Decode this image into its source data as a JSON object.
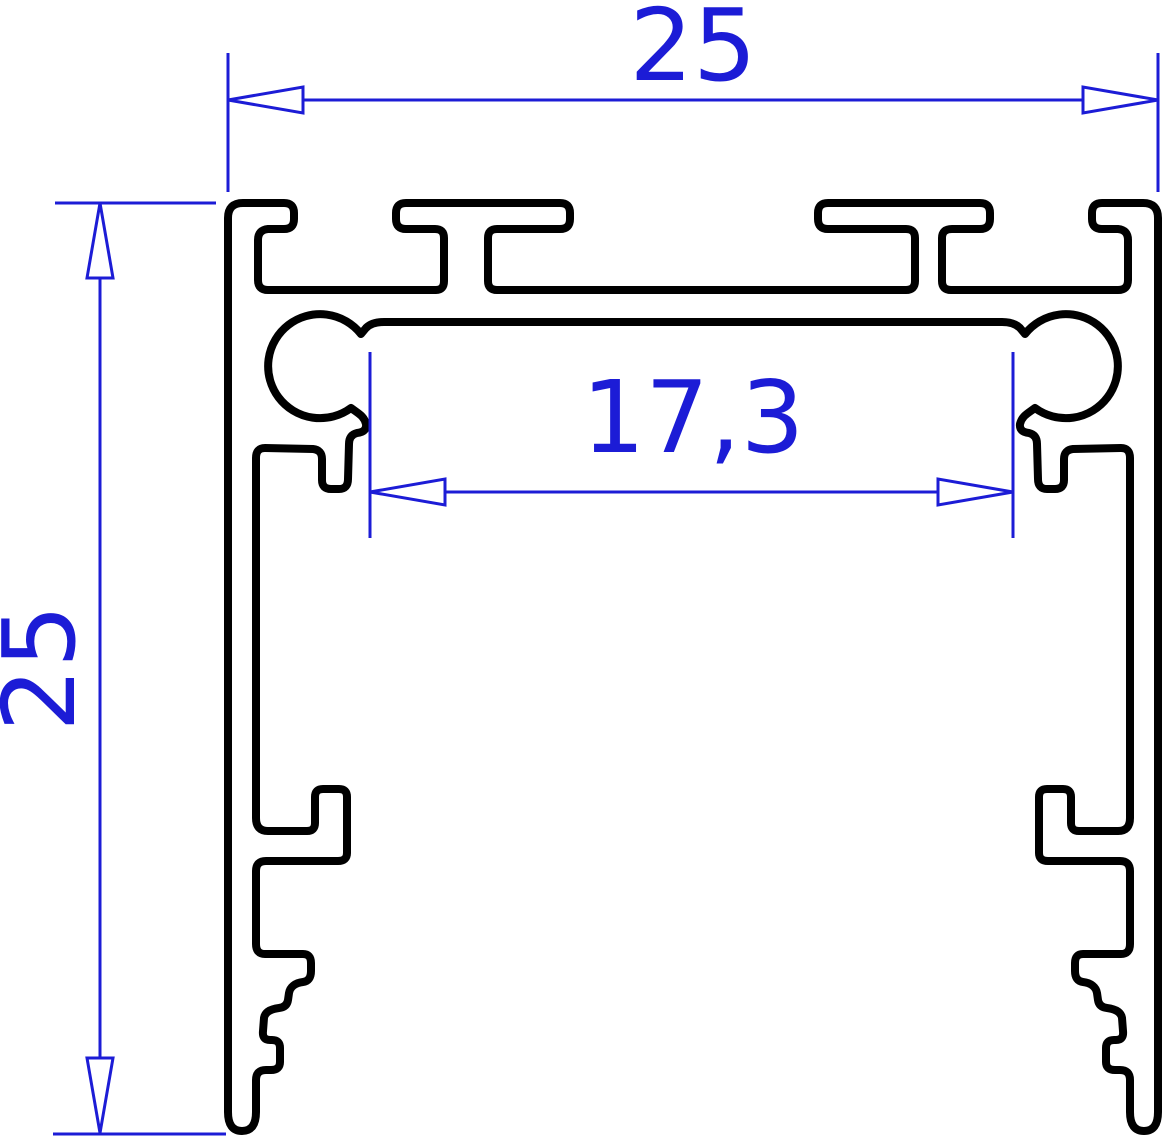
{
  "drawing": {
    "title": "Aluminium LED profile cross-section",
    "type": "technical-2d-drawing",
    "colors": {
      "outline": "#000000",
      "dimension": "#1c1cd6",
      "background": "#ffffff"
    },
    "dimensions": {
      "overall_width": {
        "label": "25",
        "orientation": "horizontal",
        "position": "top"
      },
      "overall_height": {
        "label": "25",
        "orientation": "vertical",
        "position": "left"
      },
      "inner_width": {
        "label": "17,3",
        "orientation": "horizontal",
        "position": "middle"
      }
    }
  }
}
